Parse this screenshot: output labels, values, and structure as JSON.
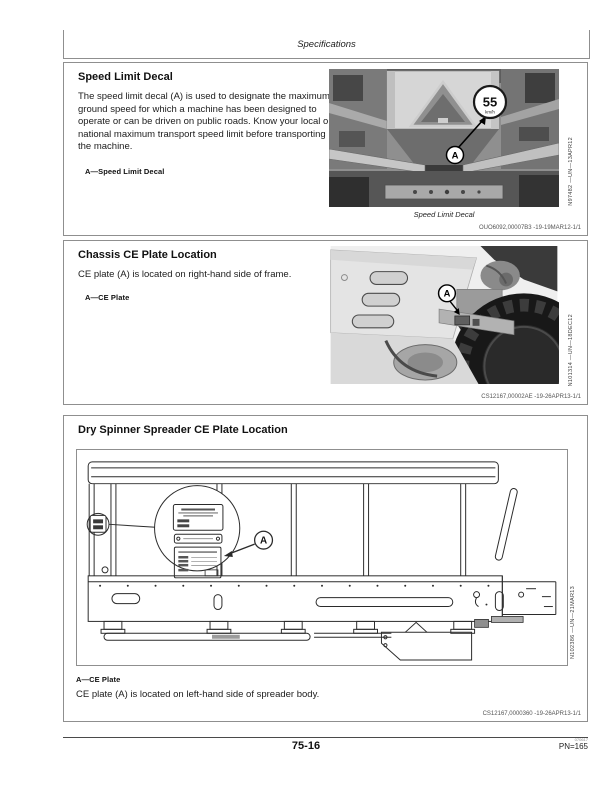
{
  "page": {
    "header_title": "Specifications",
    "footer": {
      "page_number": "75-16",
      "print_code": "070617",
      "pn_label": "PN=165"
    }
  },
  "sections": {
    "speed_limit": {
      "title": "Speed Limit Decal",
      "body": "The speed limit decal (A) is used to designate the maximum ground speed for which a machine has been designed to operate or can be driven on public roads. Know your local or national maximum transport speed limit before transporting the machine.",
      "legend": "A—Speed Limit Decal",
      "figure": {
        "caption": "Speed Limit Decal",
        "image_code": "N97482 —UN—13APR12",
        "callout_label": "A",
        "decal_speed": "55",
        "decal_unit": "km/h"
      },
      "ref_code": "OUO6092,00007B3 -19-19MAR12-1/1"
    },
    "chassis_ce": {
      "title": "Chassis CE Plate Location",
      "body": "CE plate (A) is located on right-hand side of frame.",
      "legend": "A—CE Plate",
      "figure": {
        "image_code": "N101314 —UN—18DEC12",
        "callout_label": "A"
      },
      "ref_code": "CS12167,00002AE -19-26APR13-1/1"
    },
    "spreader_ce": {
      "title": "Dry Spinner Spreader CE Plate Location",
      "legend": "A—CE Plate",
      "body": "CE plate (A) is located on left-hand side of spreader body.",
      "figure": {
        "image_code": "N102386 —UN—21MAR13",
        "callout_label": "A"
      },
      "ref_code": "CS12167,0000360 -19-26APR13-1/1"
    }
  }
}
